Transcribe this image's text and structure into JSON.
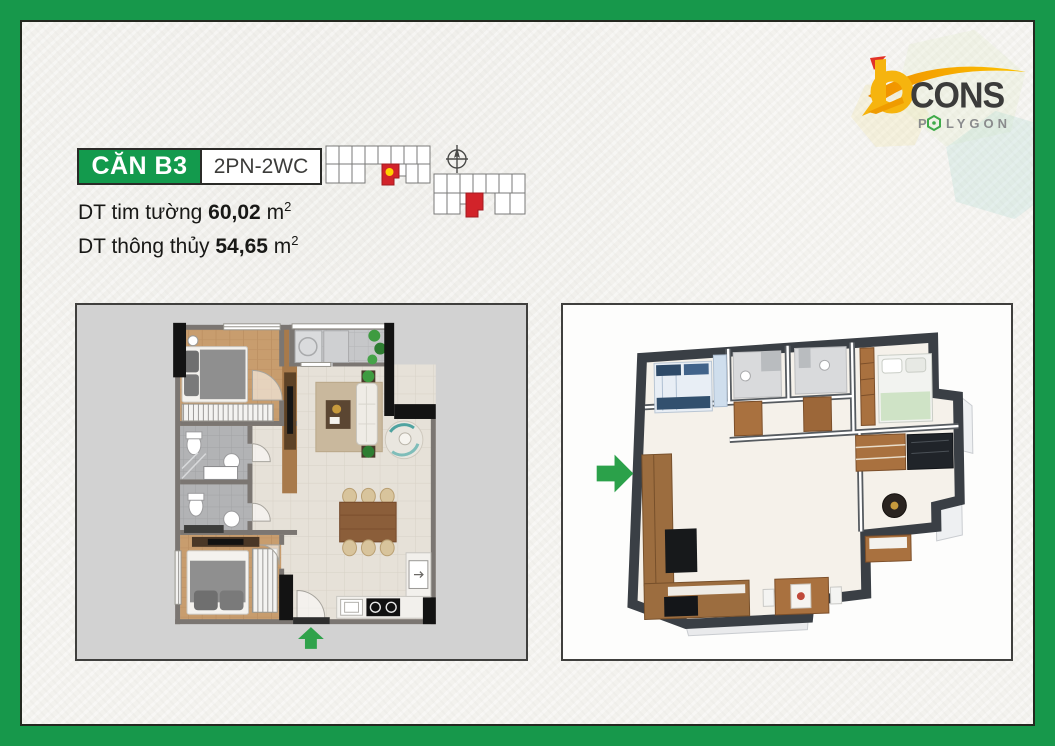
{
  "frame": {
    "color": "#17984b"
  },
  "unit": {
    "name": "CĂN B3",
    "type": "2PN-2WC"
  },
  "areas": [
    {
      "label": "DT tim tường",
      "value": "60,02",
      "unit": "m",
      "exp": "2"
    },
    {
      "label": "DT thông thủy",
      "value": "54,65",
      "unit": "m",
      "exp": "2"
    }
  ],
  "logo": {
    "cons": "CONS",
    "poly_p": "P",
    "poly_rest": "LYGON"
  },
  "colors": {
    "label_green": "#139a4d",
    "highlight_red": "#d2232a",
    "marker_yellow": "#ffd200",
    "arrow_green": "#2fa24b",
    "logo_yellow": "#f6b40e",
    "logo_orange": "#f39200",
    "logo_red": "#e23127",
    "logo_gray": "#8a8b8d",
    "logo_dark": "#3b3b3a",
    "hex_green": "#3faa49"
  }
}
